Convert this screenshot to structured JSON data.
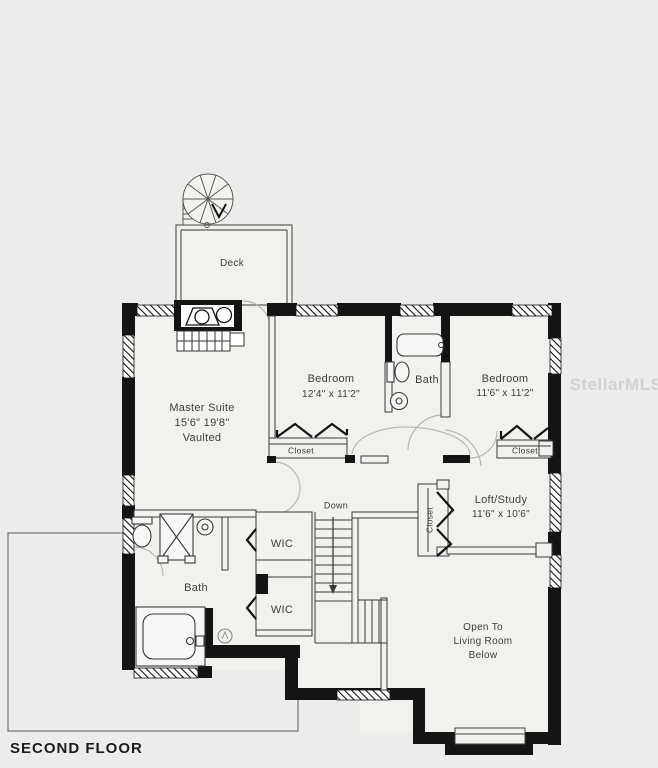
{
  "page": {
    "title_label": "SECOND FLOOR",
    "watermark": "StellarMLS"
  },
  "colors": {
    "wall": "#141414",
    "text": "#3f3e3c",
    "background": "#eeecea",
    "interior": "#f3f1ee",
    "door_arc": "#b9b7b4"
  },
  "rooms": {
    "deck": {
      "name": "Deck"
    },
    "master_suite": {
      "name": "Master Suite",
      "dims": "15'6\" 19'8\"",
      "note": "Vaulted"
    },
    "bedroom1": {
      "name": "Bedroom",
      "dims": "12'4\" x 11'2\""
    },
    "bath_upper": {
      "name": "Bath"
    },
    "bedroom2": {
      "name": "Bedroom",
      "dims": "11'6\" x 11'2\""
    },
    "loft": {
      "name": "Loft/Study",
      "dims": "11'6\" x 10'6\""
    },
    "bath_lower": {
      "name": "Bath"
    },
    "open_below": {
      "line1": "Open To",
      "line2": "Living Room",
      "line3": "Below"
    },
    "closet_bedroom1": {
      "name": "Closet"
    },
    "closet_bedroom2": {
      "name": "Closet"
    },
    "closet_loft": {
      "name": "Closet"
    },
    "wic1": {
      "name": "WIC"
    },
    "wic2": {
      "name": "WIC"
    },
    "stairs": {
      "label": "Down"
    }
  }
}
